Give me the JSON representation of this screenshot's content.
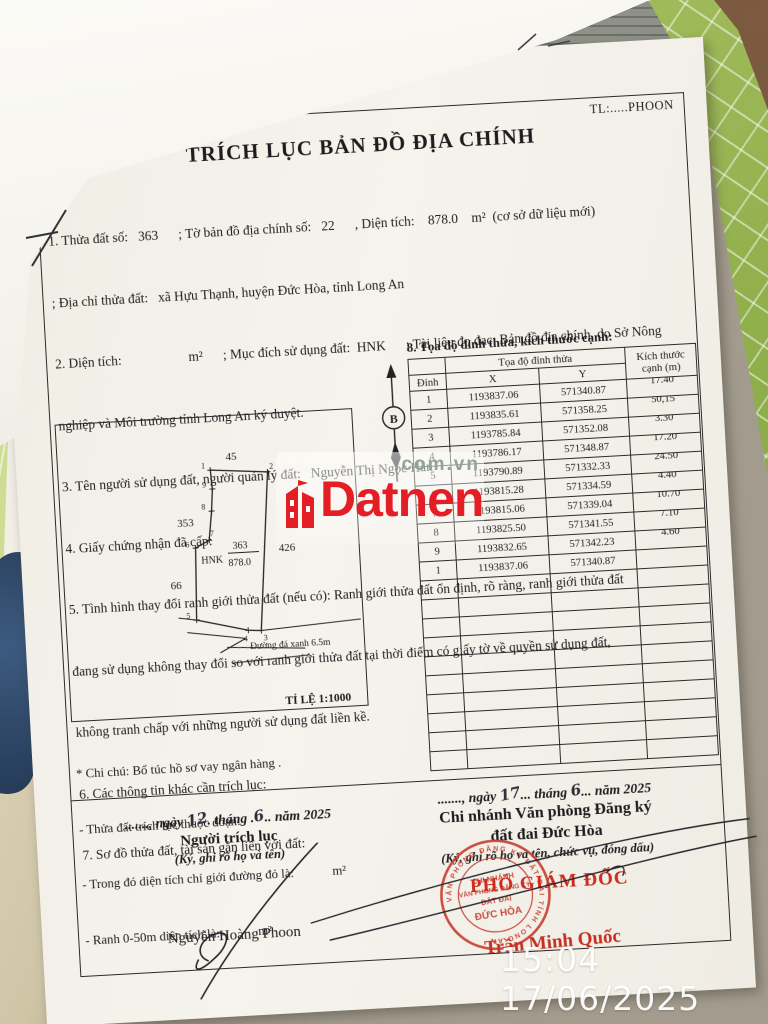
{
  "overlay": {
    "watermark_brand": "Datnen",
    "watermark_domain": ".com.vn",
    "timestamp": "15:04 17/06/2025"
  },
  "doc": {
    "corner_ref": "TL:.....PHOON",
    "title": "TRÍCH LỤC BẢN ĐỒ ĐỊA CHÍNH",
    "lines": [
      "1. Thửa đất số:   363      ; Tờ bản đồ địa chính số:   22      , Diện tích:    878.0    m²  (cơ sở dữ liệu mới)",
      "; Địa chỉ thửa đất:   xã Hựu Thạnh, huyện Đức Hòa, tỉnh Long An",
      "2. Diện tích:                    m²      ; Mục đích sử dụng đất:  HNK      ; Tài liệu đo đạc: Bản đồ địa chính  do Sở Nông",
      "nghiệp và Môi trường tỉnh Long An ký duyệt.",
      "3. Tên người sử dụng đất, người quản lý đất:   Nguyễn Thị Ngọc Hân",
      "4. Giấy chứng nhận đã cấp:",
      "5. Tình hình thay đổi ranh giới thửa đất (nếu có): Ranh giới thửa đất ổn định, rõ ràng, ranh giới thửa đất",
      "đang sử dụng không thay đổi so với ranh giới thửa đất tại thời điểm có giấy tờ về quyền sử dụng đất,",
      "không tranh chấp với những người sử dụng đất liền kề.",
      "6. Các thông tin khác cần trích lục:",
      "7. Sơ đồ thửa đất, tài sản gắn liền với đất:"
    ],
    "diagram": {
      "neighbor_top": "45",
      "neighbor_left_upper": "353",
      "neighbor_right": "426",
      "neighbor_left_lower": "66",
      "vertex_labels": [
        "1",
        "2",
        "3",
        "4",
        "5",
        "6",
        "7",
        "8",
        "9"
      ],
      "parcel_code": "HNK",
      "parcel_number": "363",
      "parcel_area": "878.0",
      "road_label": "Đường đá xanh 6.5m",
      "scale_label": "TỈ LỆ 1:1000",
      "north_label": "B"
    },
    "table": {
      "heading": "8. Tọa độ đỉnh thửa, kích thước cạnh:",
      "group_header": "Tọa độ đỉnh thửa",
      "col_vertex": "Đỉnh",
      "col_x": "X",
      "col_y": "Y",
      "col_size_1": "Kích thước",
      "col_size_2": "cạnh (m)",
      "rows": [
        {
          "v": "1",
          "x": "1193837.06",
          "y": "571340.87",
          "d": "17.40"
        },
        {
          "v": "2",
          "x": "1193835.61",
          "y": "571358.25",
          "d": "50,15"
        },
        {
          "v": "3",
          "x": "1193785.84",
          "y": "571352.08",
          "d": "3.30"
        },
        {
          "v": "4",
          "x": "1193786.17",
          "y": "571348.87",
          "d": "17.20"
        },
        {
          "v": "5",
          "x": "1193790.89",
          "y": "571332.33",
          "d": "24.50"
        },
        {
          "v": "6",
          "x": "1193815.28",
          "y": "571334.59",
          "d": "4.40"
        },
        {
          "v": "7",
          "x": "1193815.06",
          "y": "571339.04",
          "d": "10.70"
        },
        {
          "v": "8",
          "x": "1193825.50",
          "y": "571341.55",
          "d": "7.10"
        },
        {
          "v": "9",
          "x": "1193832.65",
          "y": "571342.23",
          "d": "4.60"
        },
        {
          "v": "1",
          "x": "1193837.06",
          "y": "571340.87",
          "d": ""
        }
      ],
      "empty_rows": 10
    },
    "notes": [
      "* Chi chú: Bổ túc hồ sơ vay ngân hàng .",
      "- Thửa đất trích lục thuộc đoạn:",
      "- Trong đó diện tích chỉ giới đường đỏ là:            m²",
      "- Ranh 0-50m diện tích là:            m²"
    ],
    "sign_left": {
      "date_prefix": "......., ngày",
      "day": "12",
      "date_mid": ". tháng .",
      "month": "6",
      "date_suffix": ".. năm 2025",
      "role": "Người trích lục",
      "hint": "(Ký, ghi rõ họ và tên)",
      "name": "Nguyễn Hoàng Phoon"
    },
    "sign_right": {
      "date_prefix": "......., ngày",
      "day": "17",
      "date_mid": "... tháng",
      "month": "6",
      "date_suffix": "... năm 2025",
      "org_line1": "Chi nhánh Văn phòng Đăng ký",
      "org_line2": "đất đai Đức Hòa",
      "hint": "(Ký, ghi rõ họ và tên, chức vụ, đóng dấu)",
      "title_red": "PHÓ GIÁM ĐỐC",
      "name_red": "Trần Minh Quốc"
    },
    "stamp": {
      "ring": "VĂN PHÒNG ĐĂNG KÝ ĐẤT ĐAI TỈNH LONG AN",
      "line1": "CHI NHÁNH",
      "line2": "VĂN PHÒNG ĐĂNG KÝ",
      "line3": "ĐẤT ĐAI",
      "line4": "ĐỨC HÒA"
    }
  },
  "colors": {
    "stamp_red": "#c84133",
    "accent_red": "#cc2b1d",
    "watermark_red": "#e51e25",
    "mat_green": "#90b04c"
  }
}
